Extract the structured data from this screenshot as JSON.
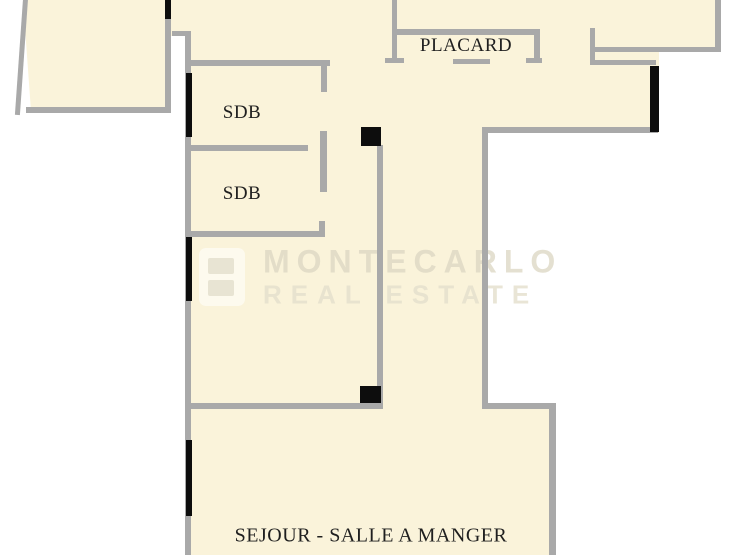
{
  "plan": {
    "title": "apartment floor plan",
    "rooms": [
      {
        "id": "placard",
        "label": "PLACARD"
      },
      {
        "id": "sdb-1",
        "label": "SDB"
      },
      {
        "id": "sdb-2",
        "label": "SDB"
      },
      {
        "id": "sejour",
        "label": "SEJOUR - SALLE A MANGER"
      }
    ],
    "watermark": {
      "line1": "MONTECARLO",
      "line2": "REAL ESTATE",
      "logo": "montecarlo-real-estate-logo"
    },
    "colors": {
      "floor": "#faf3da",
      "wall": "#a9a9a9",
      "feature": "#0d0d0d",
      "outside": "#ffffff",
      "label": "#1f1f1f"
    }
  }
}
